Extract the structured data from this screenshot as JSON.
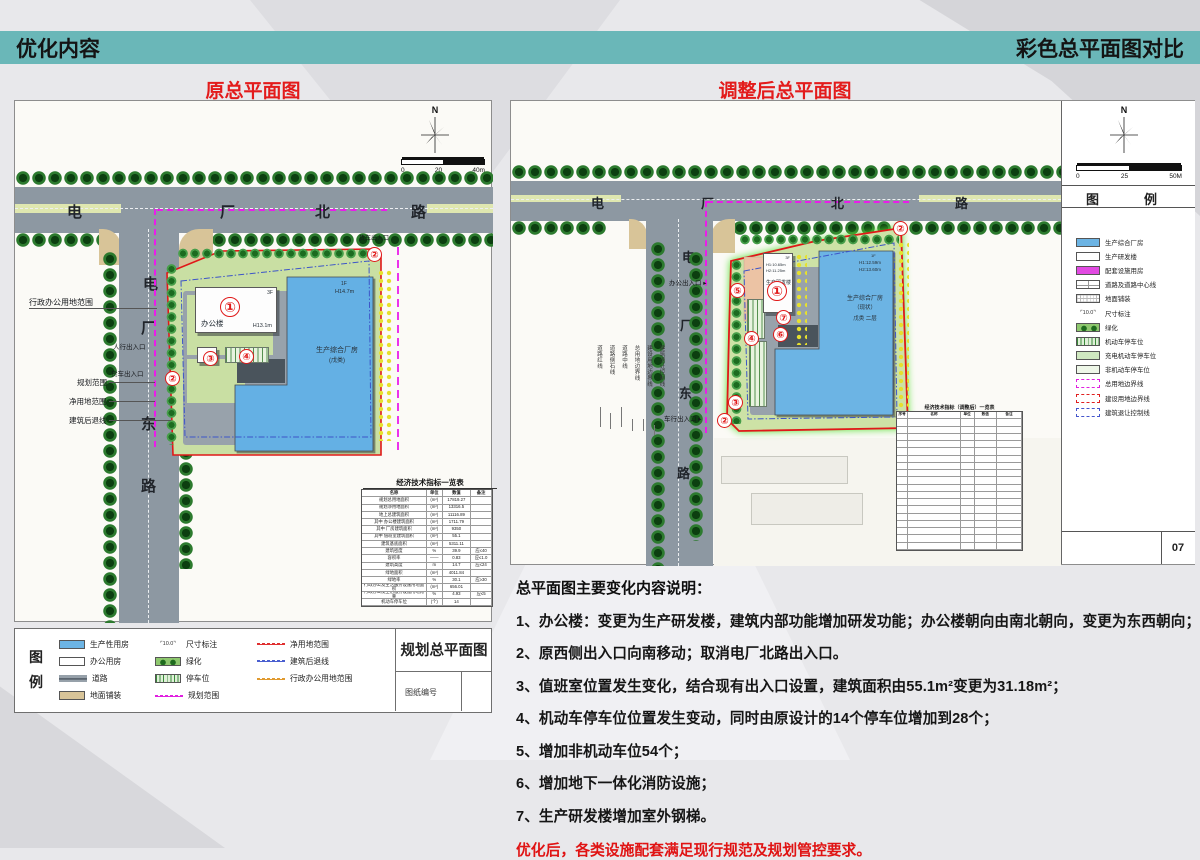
{
  "header": {
    "left_title": "优化内容",
    "right_title": "彩色总平面图对比"
  },
  "left_plan": {
    "title": "原总平面图",
    "north_label": "N",
    "scale": {
      "t0": "0",
      "t1": "20",
      "t2": "40m"
    },
    "road_north_chars": [
      "电",
      "厂",
      "北",
      "路"
    ],
    "road_east_chars": [
      "电",
      "厂",
      "东",
      "路"
    ],
    "labels": {
      "admin_land": "行政办公用地范围",
      "pedestrian_entrance": "人行出入口",
      "truck_entrance": "货车出入口",
      "truck_entrance_north": "货车出入口",
      "planning_scope": "规划范围",
      "net_land": "净用地范围",
      "setback": "建筑后退线"
    },
    "office": {
      "name": "办公楼",
      "floors": "3F",
      "height": "H13.1m"
    },
    "factory": {
      "name": "生产综合厂房",
      "category": "(戊类)",
      "floors": "1F",
      "height": "H14.7m"
    },
    "markers": [
      "①",
      "②",
      "③",
      "④",
      "②"
    ],
    "table": {
      "title": "经济技术指标一览表",
      "headers": [
        "名称",
        "单位",
        "数值",
        "备注"
      ],
      "rows": [
        {
          "c1": "规划总用地面积",
          "c2": "(m²)",
          "c3": "17819.27",
          "c4": ""
        },
        {
          "c1": "规划净用地面积",
          "c2": "(m²)",
          "c3": "13316.5",
          "c4": ""
        },
        {
          "c1": "地上总建筑面积",
          "c2": "(m²)",
          "c3": "11116.89",
          "c4": ""
        },
        {
          "c1": "其中 办公楼建筑面积",
          "c2": "(m²)",
          "c3": "1711.79",
          "c4": ""
        },
        {
          "c1": "其中 厂房建筑面积",
          "c2": "(m²)",
          "c3": "9350",
          "c4": ""
        },
        {
          "c1": "其中 值班室建筑面积",
          "c2": "(m²)",
          "c3": "55.1",
          "c4": ""
        },
        {
          "c1": "建筑基底面积",
          "c2": "(m²)",
          "c3": "5311.11",
          "c4": ""
        },
        {
          "c1": "建筑密度",
          "c2": "%",
          "c3": "39.9",
          "c4": "应≤40"
        },
        {
          "c1": "容积率",
          "c2": "——",
          "c3": "0.83",
          "c4": "应≤1.0"
        },
        {
          "c1": "建筑高度",
          "c2": "m",
          "c3": "14.7",
          "c4": "应≤24"
        },
        {
          "c1": "绿地面积",
          "c2": "(m²)",
          "c3": "4011.84",
          "c4": ""
        },
        {
          "c1": "绿地率",
          "c2": "%",
          "c3": "30.1",
          "c4": "应≥30"
        },
        {
          "c1": "行政办公及生活服务设施用地面积",
          "c2": "(m²)",
          "c3": "656.01",
          "c4": ""
        },
        {
          "c1": "行政办公及生活服务设施用地比重",
          "c2": "%",
          "c3": "4.93",
          "c4": "应≤5"
        },
        {
          "c1": "机动车停车位",
          "c2": "(个)",
          "c3": "14",
          "c4": ""
        }
      ]
    }
  },
  "left_legend": {
    "box_label_top": "图",
    "box_label_bottom": "例",
    "items": [
      {
        "label": "生产性用房",
        "type": "sw sw-blue"
      },
      {
        "label": "办公用房",
        "type": "sw sw-white"
      },
      {
        "label": "道路",
        "type": "sw sym-roadL"
      },
      {
        "label": "地面铺装",
        "type": "sw sw-tan"
      },
      {
        "label": "尺寸标注",
        "type": "sw sym-dim"
      },
      {
        "label": "绿化",
        "type": "sw sym-green"
      },
      {
        "label": "停车位",
        "type": "sw sym-park"
      },
      {
        "label": "规划范围",
        "type": "line-dash lm"
      },
      {
        "label": "净用地范围",
        "type": "line-dash lr"
      },
      {
        "label": "建筑后退线",
        "type": "line-dash lb"
      },
      {
        "label": "行政办公用地范围",
        "type": "line-dash lo"
      }
    ],
    "title_block": {
      "name": "规划总平面图",
      "sheet_no_label": "图纸编号"
    }
  },
  "right_plan": {
    "title": "调整后总平面图",
    "north_label": "N",
    "scale": {
      "t0": "0",
      "t1": "25",
      "t2": "50M"
    },
    "road_north_chars": [
      "电",
      "厂",
      "北",
      "路"
    ],
    "road_east_chars": [
      "电",
      "厂",
      "东",
      "路"
    ],
    "labels": {
      "office_entrance": "办公出入口",
      "vehicle_entrance": "车行出入口"
    },
    "road_line_labels": [
      "道路红线",
      "道路侧石线",
      "道路中线",
      "总用地边界线",
      "建设用地边界线",
      "建筑退让控制线"
    ],
    "rd_building": {
      "name": "生产研发楼",
      "floors": "3F",
      "h1": "H1:10.65m",
      "h2": "H2:11.25m"
    },
    "factory": {
      "name": "生产综合厂房",
      "status": "（现状）",
      "category": "戊类 二层",
      "floors": "1F",
      "h1": "H1:12.59m",
      "h2": "H2:13.60m"
    },
    "markers": [
      "⑤",
      "①",
      "⑦",
      "⑥",
      "④",
      "③",
      "②",
      "②"
    ],
    "table": {
      "title": "经济技术指标（调整后）一览表",
      "headers": [
        "序号",
        "名称",
        "单位",
        "数值",
        "备注"
      ]
    },
    "legend": {
      "header_left": "图",
      "header_right": "例",
      "items": [
        {
          "label": "生产综合厂房",
          "type": "sw sw-blue"
        },
        {
          "label": "生产研发楼",
          "type": "sw sw-white"
        },
        {
          "label": "配套设施用房",
          "type": "sw sw-magenta"
        },
        {
          "label": "道路及道路中心线",
          "type": "sw sym-road2"
        },
        {
          "label": "地面铺装",
          "type": "sw sym-paving"
        },
        {
          "label": "尺寸标注",
          "type": "sw sym-dim"
        },
        {
          "label": "绿化",
          "type": "sw sym-green"
        },
        {
          "label": "机动车停车位",
          "type": "sw sym-park"
        },
        {
          "label": "充电机动车停车位",
          "type": "sw sym-park sym-park-ev"
        },
        {
          "label": "非机动车停车位",
          "type": "sw sym-park sym-park-nm"
        },
        {
          "label": "总用地边界线",
          "type": "box-dash box-magenta"
        },
        {
          "label": "建设用地边界线",
          "type": "box-dash box-red"
        },
        {
          "label": "建筑退让控制线",
          "type": "box-dash box-blue"
        }
      ],
      "page_number": "07"
    }
  },
  "notes": {
    "title": "总平面图主要变化内容说明：",
    "items": [
      "1、办公楼：变更为生产研发楼，建筑内部功能增加研发功能；办公楼朝向由南北朝向，变更为东西朝向；",
      "2、原西侧出入口向南移动；取消电厂北路出入口。",
      "3、值班室位置发生变化，结合现有出入口设置，建筑面积由55.1m²变更为31.18m²；",
      "4、机动车停车位位置发生变动，同时由原设计的14个停车位增加到28个；",
      "5、增加非机动车位54个；",
      "6、增加地下一体化消防设施；",
      "7、生产研发楼增加室外钢梯。"
    ],
    "conclusion": "优化后，各类设施配套满足现行规范及规划管控要求。"
  }
}
